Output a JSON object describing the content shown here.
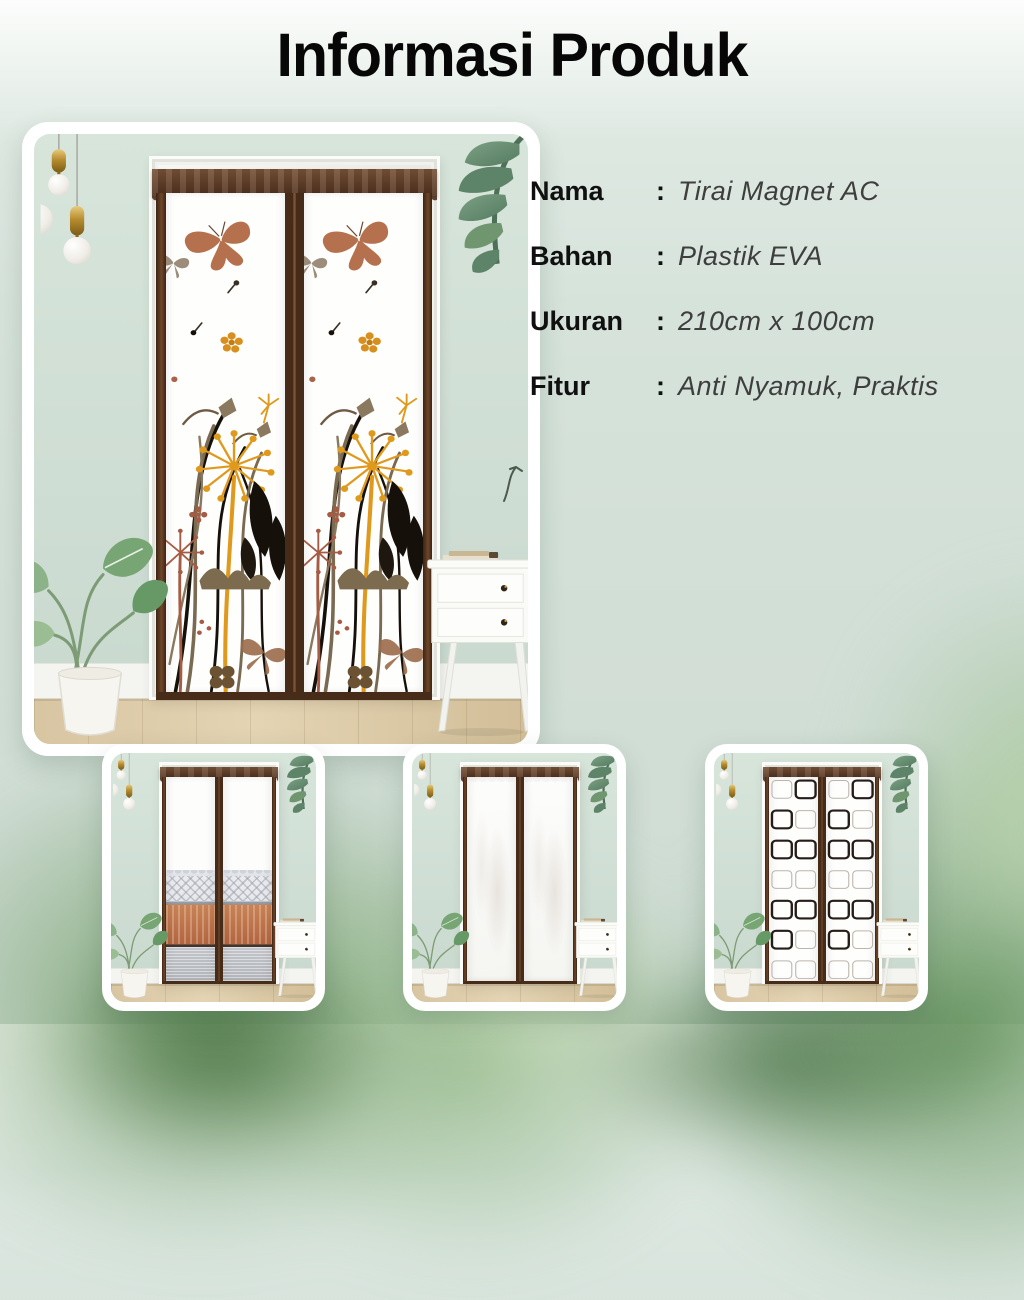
{
  "title": "Informasi Produk",
  "info": {
    "rows": [
      {
        "label": "Nama",
        "separator": ":",
        "value": "Tirai Magnet AC"
      },
      {
        "label": "Bahan",
        "separator": ":",
        "value": "Plastik EVA"
      },
      {
        "label": "Ukuran",
        "separator": ":",
        "value": "210cm x 100cm"
      },
      {
        "label": "Fitur",
        "separator": ":",
        "value": "Anti Nyamuk, Praktis"
      }
    ]
  },
  "gallery": {
    "main_photo": "magnetic-door-curtain-dandelion-butterfly-room-scene",
    "thumbnails": [
      {
        "name": "variant-lace-copper-curtain"
      },
      {
        "name": "variant-plain-white-curtain"
      },
      {
        "name": "variant-square-pattern-curtain"
      }
    ]
  },
  "colors": {
    "background_mint": "#d3e0d8",
    "title_text": "#070707",
    "label_text": "#101010",
    "value_text": "#3e3e3e",
    "curtain_brown": "#5a3a27",
    "dandelion_orange": "#df9a1e",
    "butterfly_copper": "#b5714d",
    "leaf_green": "#6f9e6e"
  }
}
